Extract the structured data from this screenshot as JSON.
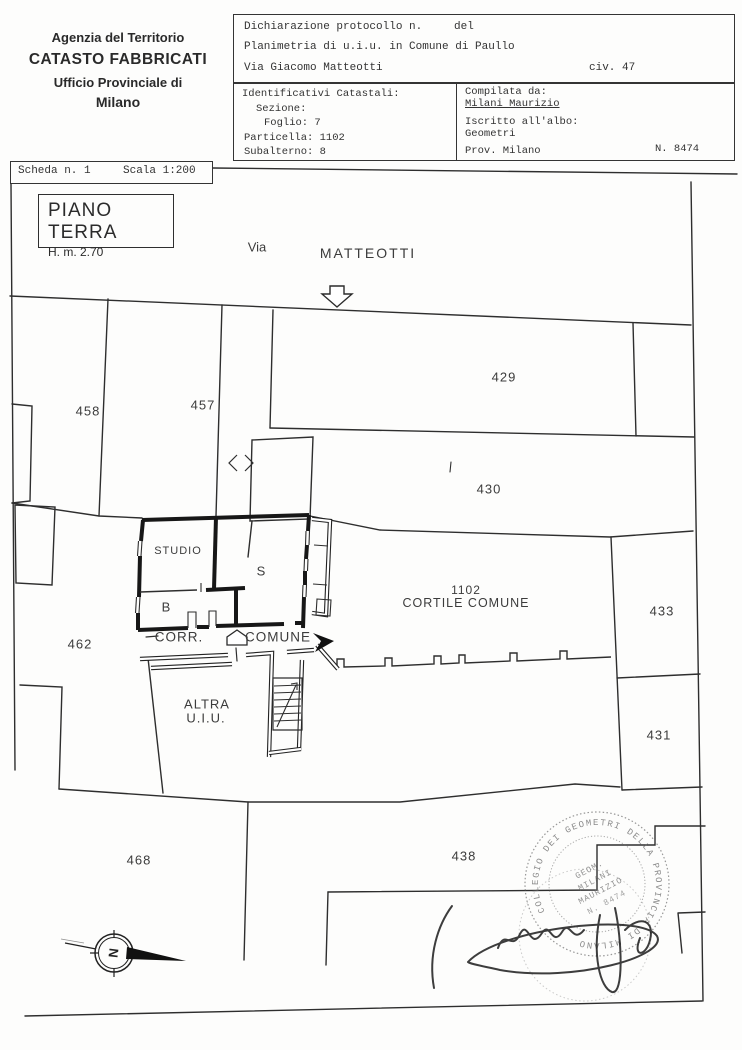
{
  "agency": {
    "line1": "Agenzia del Territorio",
    "line2": "CATASTO FABBRICATI",
    "line3": "Ufficio Provinciale di",
    "line4": "Milano"
  },
  "declaration": {
    "protocol_label": "Dichiarazione protocollo n.",
    "del_label": "del",
    "planimetria": "Planimetria di u.i.u. in Comune di Paullo",
    "street": "Via Giacomo Matteotti",
    "civ": "civ. 47"
  },
  "identifiers": {
    "title": "Identificativi Catastali:",
    "sezione": "Sezione:",
    "foglio": "Foglio: 7",
    "particella": "Particella: 1102",
    "subalterno": "Subalterno: 8"
  },
  "compiler": {
    "label": "Compilata da:",
    "name": "Milani Maurizio",
    "albo_label": "Iscritto all'albo:",
    "albo": "Geometri",
    "prov": "Prov. Milano",
    "number": "N. 8474"
  },
  "sheet": {
    "scheda": "Scheda n. 1",
    "scala": "Scala 1:200"
  },
  "floor": {
    "title": "PIANO TERRA",
    "height": "H. m. 2.70"
  },
  "street": {
    "via": "Via",
    "name": "MATTEOTTI"
  },
  "plan": {
    "plot_458": "458",
    "plot_457": "457",
    "plot_429": "429",
    "plot_430": "430",
    "plot_462": "462",
    "plot_433": "433",
    "plot_431": "431",
    "plot_468": "468",
    "plot_438": "438",
    "courtyard_number": "1102",
    "courtyard_label": "CORTILE COMUNE",
    "room_studio": "STUDIO",
    "room_s": "S",
    "room_b": "B",
    "corr": "CORR.",
    "comune": "COMUNE",
    "altra": "ALTRA",
    "uiu": "U.I.U.",
    "north_letter": "N"
  },
  "stamp": {
    "rim_text": "COLLEGIO DEI GEOMETRI DELLA PROVINCIA DI MILANO",
    "center_line1": "GEOM.",
    "center_line2": "MILANI",
    "center_line3": "MAURIZIO",
    "center_line4": "N. 8474"
  },
  "colors": {
    "ink": "#2d2d2d",
    "wall": "#171717",
    "paper": "#fdfdfc"
  }
}
